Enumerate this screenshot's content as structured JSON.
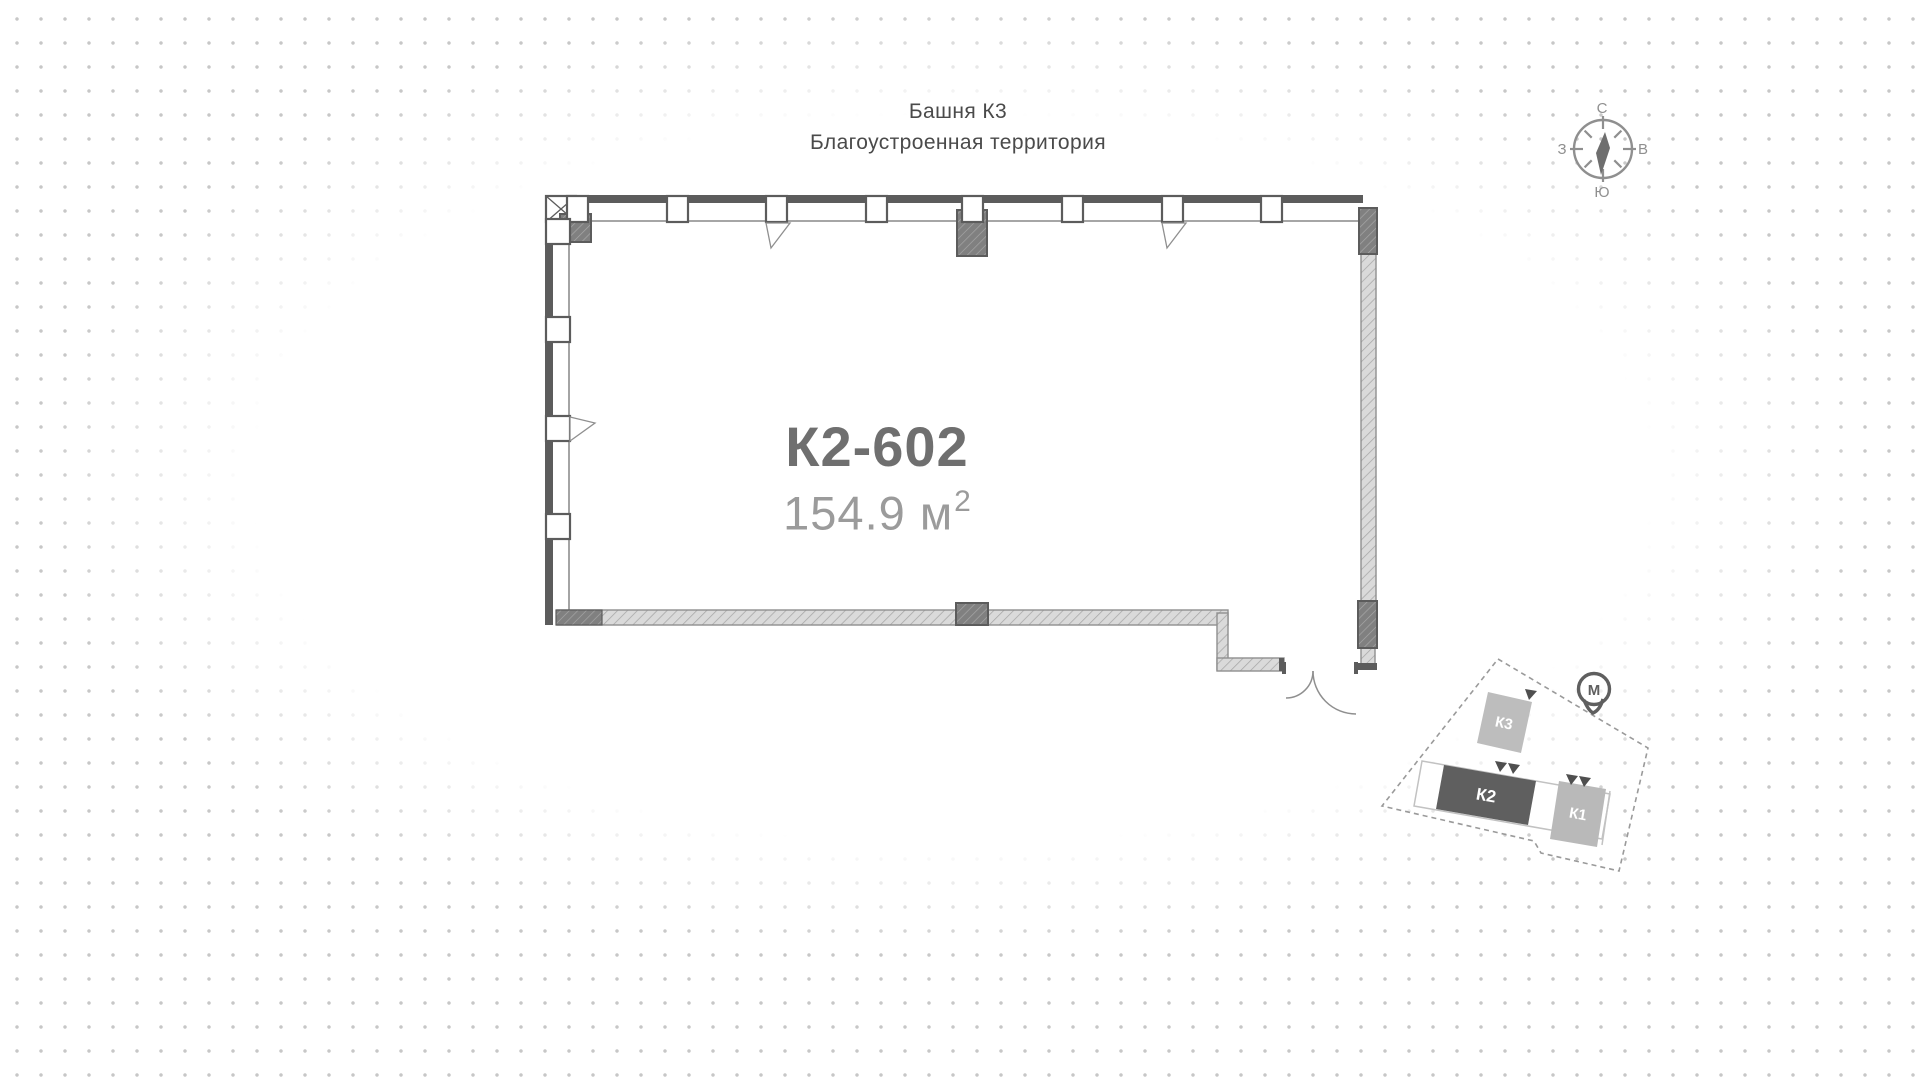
{
  "header": {
    "title": "Башня К3",
    "subtitle": "Благоустроенная территория"
  },
  "unit": {
    "id": "К2-602",
    "area": "154.9 м",
    "area_superscript": "2"
  },
  "compass": {
    "north": "С",
    "east": "В",
    "south": "Ю",
    "west": "З"
  },
  "site_plan": {
    "building_k3": "К3",
    "building_k2": "К2",
    "building_k1": "К1",
    "metro": "М",
    "highlighted_building": "К2"
  },
  "colors": {
    "wall_dark": "#5c5c5c",
    "wall_hatch_light": "#dadada",
    "line_gray": "#8f8f8f",
    "unit_id_text": "#6f6f6f",
    "unit_area_text": "#9b9b9b",
    "header_text": "#4a4a4a",
    "k2_highlight": "#5f5f5f",
    "building_gray": "#bdbdbd",
    "dot": "#c7c7c7"
  }
}
